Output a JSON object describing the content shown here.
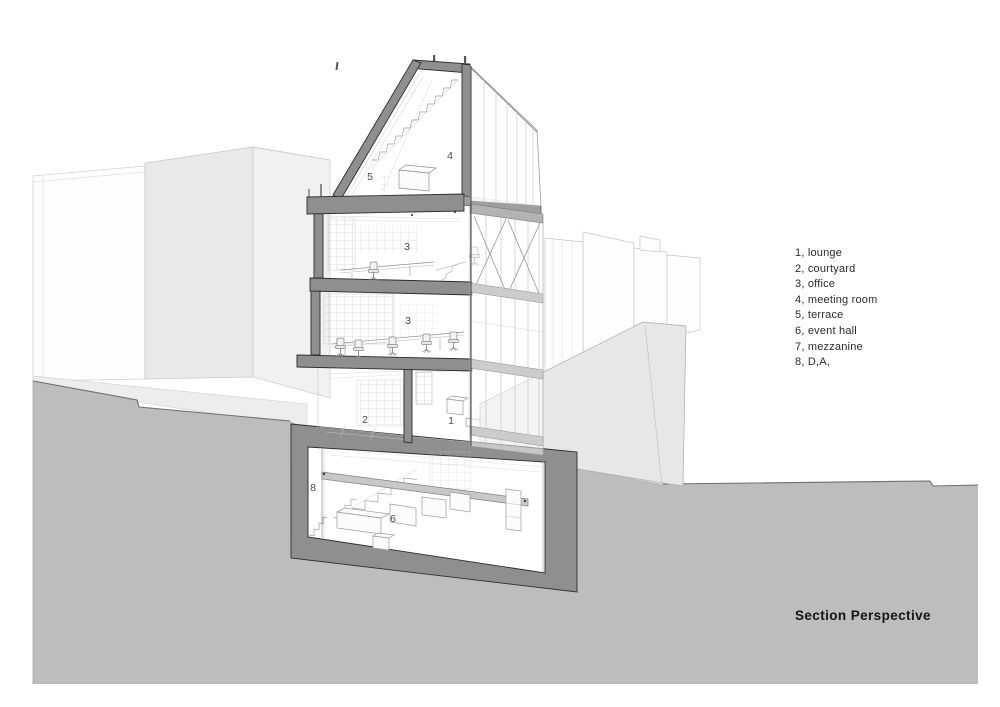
{
  "title": "Section Perspective",
  "legend": [
    "1, lounge",
    "2, courtyard",
    "3, office",
    "4, meeting room",
    "5, terrace",
    "6, event hall",
    "7, mezzanine",
    "8, D,A,"
  ],
  "floor_labels": {
    "terrace": "5",
    "meeting_room": "4",
    "office_upper": "3",
    "office_lower": "3",
    "courtyard": "2",
    "lounge": "1",
    "dry_area": "8",
    "event_hall": "6"
  },
  "colors": {
    "ground": "#bdbdbd",
    "cut_poche": "#8f8f8f",
    "background_mass": "#e9e9e9",
    "ramp": "#e7e7e7",
    "mezzanine_slab": "#c8c8c8",
    "linework": "#9a9a9a",
    "text": "#2b2b2b"
  }
}
